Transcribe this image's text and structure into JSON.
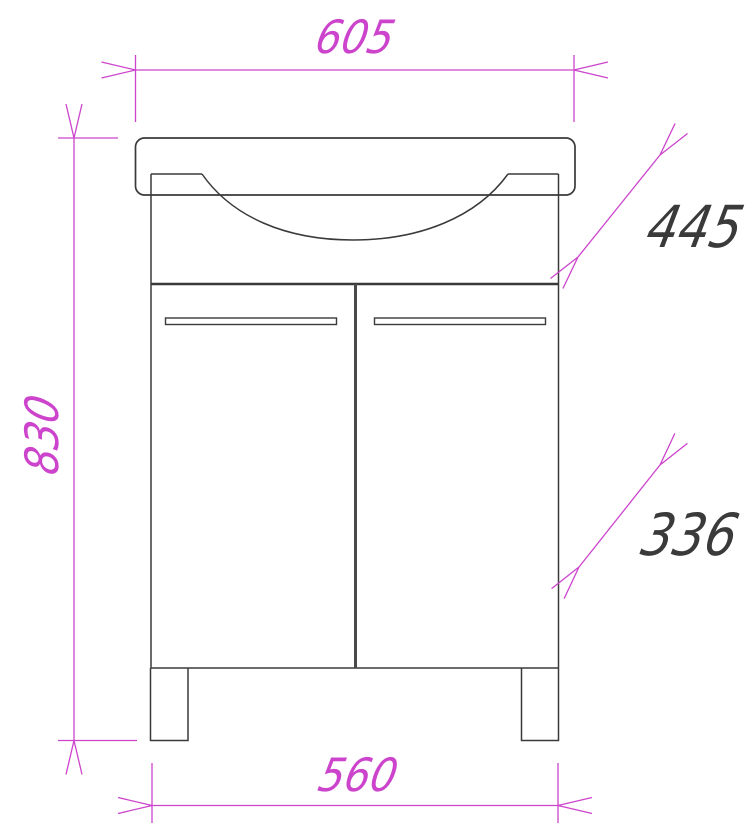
{
  "drawing": {
    "colors": {
      "background": "#ffffff",
      "outline": "#3a3a3a",
      "dimension_line": "#cc44cc",
      "dimension_text_magenta": "#cc44cc",
      "dimension_text_dark": "#3a3a3a"
    },
    "dimensions": {
      "top_width": "605",
      "overall_height": "830",
      "upper_diagonal": "445",
      "lower_diagonal": "336",
      "base_width": "560"
    }
  }
}
